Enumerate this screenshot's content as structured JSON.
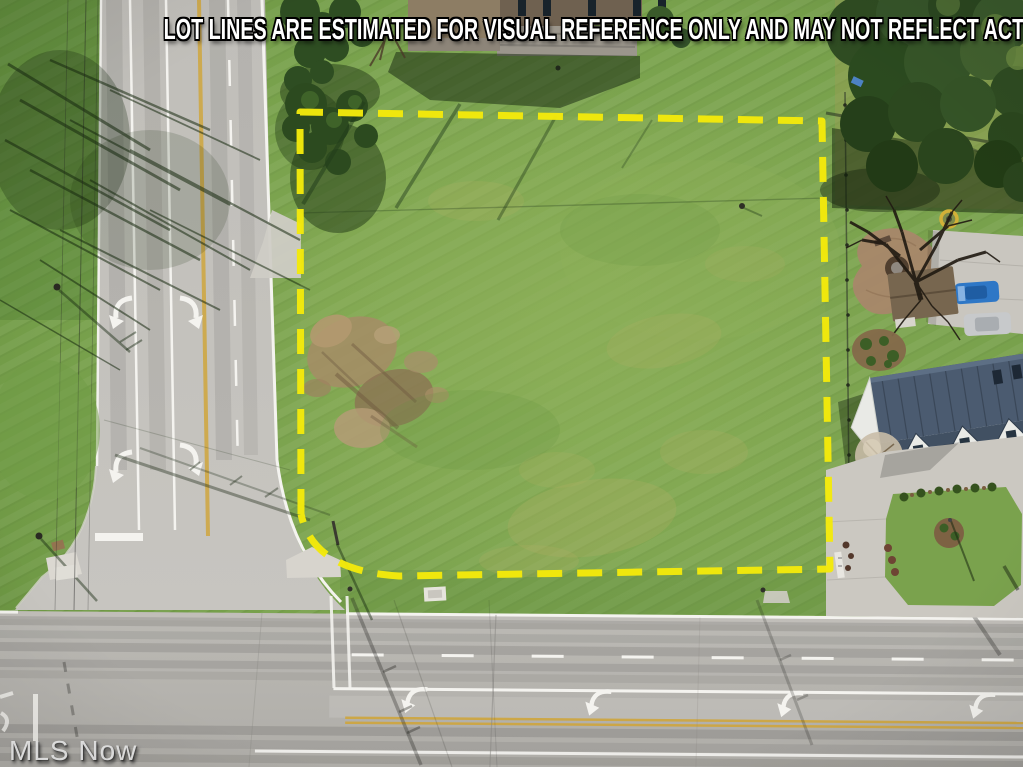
{
  "banner": {
    "text": "LOT LINES ARE ESTIMATED FOR VISUAL REFERENCE ONLY AND MAY NOT REFLECT ACTUAL PROPERTY BOUNDARIES"
  },
  "watermark": {
    "text": "MLS Now"
  },
  "lot_boundary": {
    "color": "#f3e90b",
    "line_style": "dashed"
  },
  "palette": {
    "grass": "#78a14c",
    "road": "#bcbab5",
    "concrete_driveway": "#cdcac3",
    "tree_canopy": "#33511f",
    "dirt_patch": "#a68c66",
    "north_house_roof": "#8d7d64",
    "east_house_roof": "#4b5b70",
    "blue_car": "#2e77c6",
    "silver_car": "#c7c9cb",
    "lane_yellow": "#cfa63d",
    "marking_white": "#f4f3ef"
  }
}
